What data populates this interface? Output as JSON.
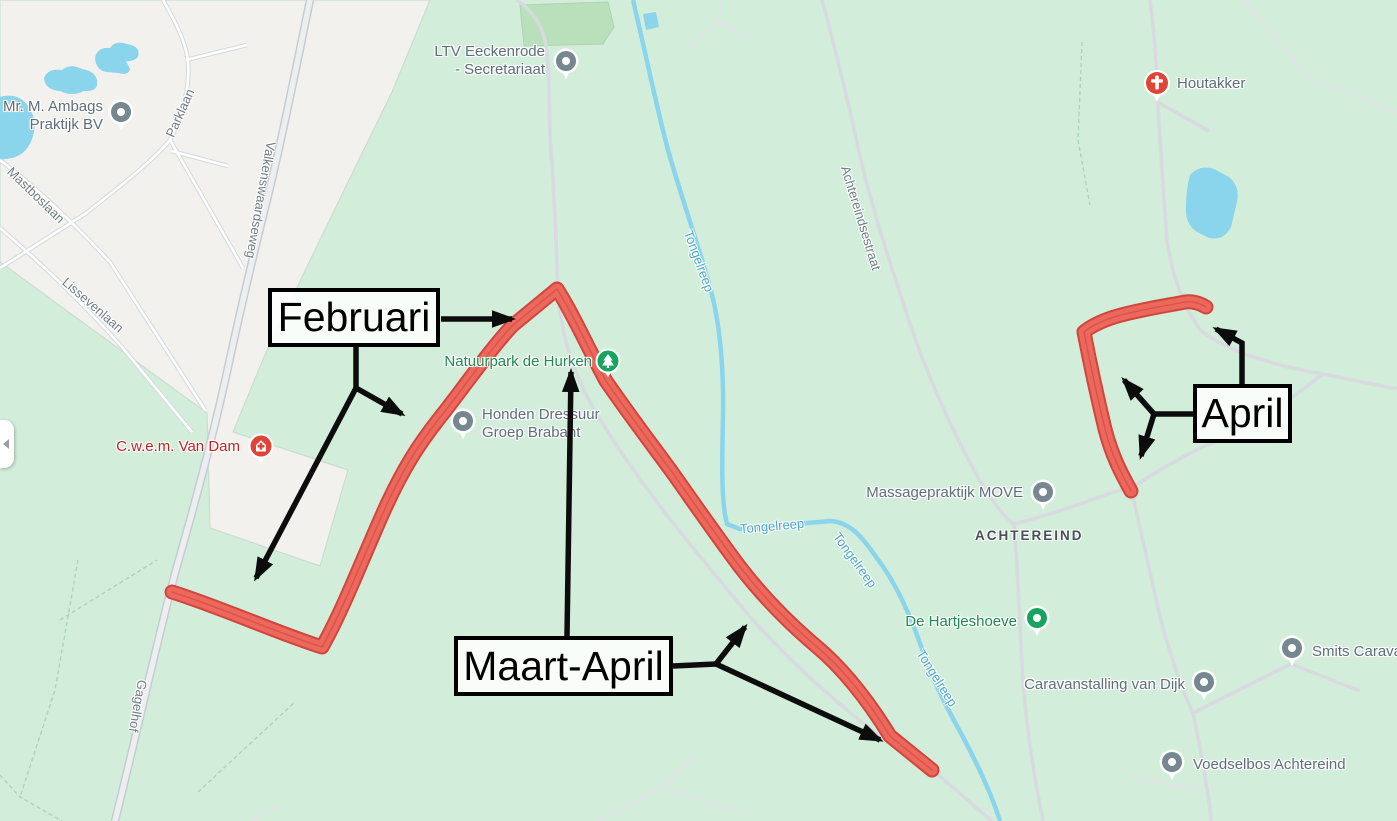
{
  "annotations": {
    "februari": "Februari",
    "maart_april": "Maart-April",
    "april": "April"
  },
  "pois": [
    {
      "name": "Mr. M. Ambags Praktijk BV",
      "marker": "gray-pin",
      "lines": [
        "Mr. M. Ambags",
        "Praktijk BV"
      ]
    },
    {
      "name": "LTV Eeckenrode - Secretariaat",
      "marker": "gray-pin",
      "lines": [
        "LTV Eeckenrode",
        "- Secretariaat"
      ]
    },
    {
      "name": "Houtakker",
      "marker": "red-church-marker",
      "lines": [
        "Houtakker"
      ]
    },
    {
      "name": "Natuurpark de Hurken",
      "marker": "green-tree-marker",
      "lines": [
        "Natuurpark de Hurken"
      ]
    },
    {
      "name": "Honden Dressuur Groep Brabant",
      "marker": "gray-pin",
      "lines": [
        "Honden Dressuur",
        "Groep Brabant"
      ]
    },
    {
      "name": "C.w.e.m. Van Dam",
      "marker": "red-health-marker",
      "lines": [
        "C.w.e.m. Van Dam"
      ]
    },
    {
      "name": "Massagepraktijk MOVE",
      "marker": "gray-pin",
      "lines": [
        "Massagepraktijk MOVE"
      ]
    },
    {
      "name": "De Hartjeshoeve",
      "marker": "green-pin",
      "lines": [
        "De Hartjeshoeve"
      ]
    },
    {
      "name": "Caravanstalling van Dijk",
      "marker": "gray-pin",
      "lines": [
        "Caravanstalling van Dijk"
      ]
    },
    {
      "name": "Smits Carava",
      "marker": "gray-pin",
      "lines": [
        "Smits Carava"
      ]
    },
    {
      "name": "Voedselbos Achtereind",
      "marker": "gray-pin",
      "lines": [
        "Voedselbos Achtereind"
      ]
    }
  ],
  "area_labels": [
    "ACHTEREIND"
  ],
  "road_labels": [
    "Parklaan",
    "Valkenswaardseweg",
    "Mastboslaan",
    "Lissevenlaan",
    "Gagelhof",
    "Achtereindsestraat"
  ],
  "water_labels": [
    "Tongelreep",
    "Tongelreep",
    "Tongelreep",
    "Tongelreep"
  ],
  "colors": {
    "map_green": "#d2edda",
    "map_green_dark": "#b9e0ba",
    "urban": "#f3f1ee",
    "water": "#8ad4ec",
    "route_red": "#ec675c",
    "route_red_edge": "#d0453c",
    "annotation_black": "#0c0c0c",
    "poi_pin_gray": "#76878f",
    "poi_pin_green": "#17a45f",
    "poi_pin_red": "#df4437",
    "label_gray": "#5e6e78",
    "label_green": "#1f8a4d",
    "label_red": "#c5221f",
    "label_blue": "#4ba7c9"
  }
}
